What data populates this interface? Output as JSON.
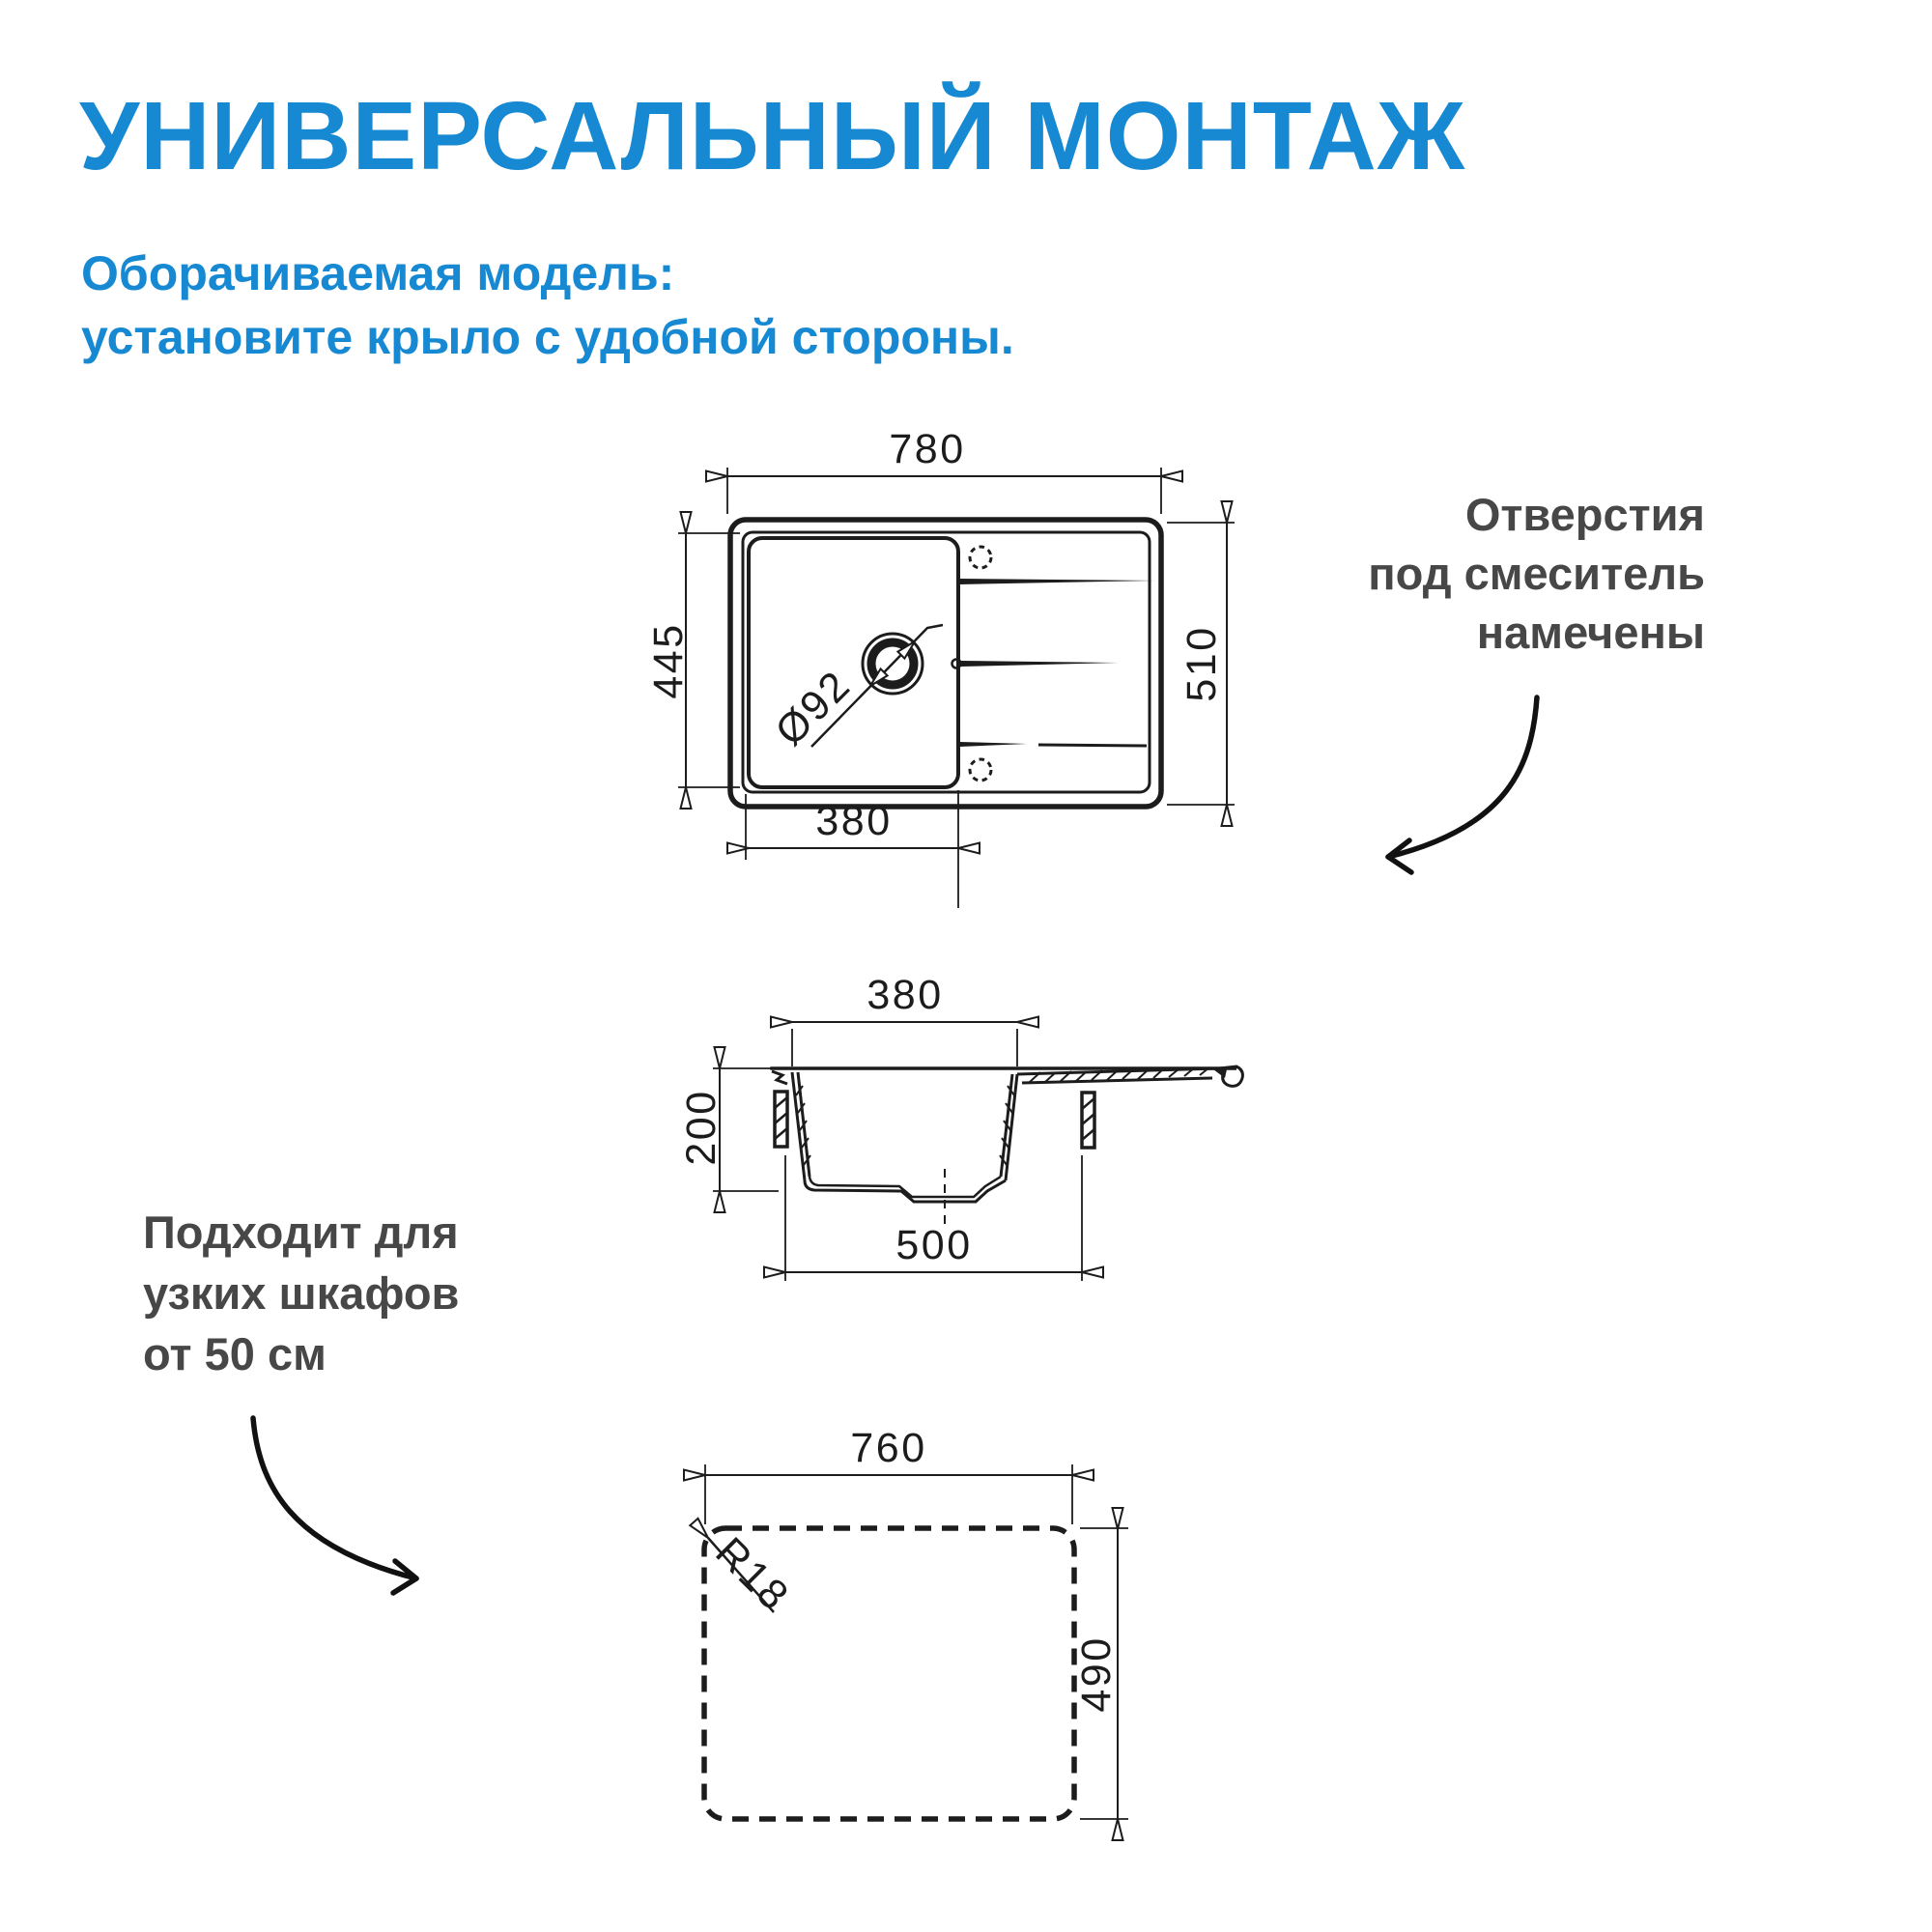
{
  "header": {
    "title": "УНИВЕРСАЛЬНЫЙ МОНТАЖ",
    "subtitle_line1": "Оборачиваемая модель:",
    "subtitle_line2": "установите крыло с удобной стороны."
  },
  "notes": {
    "faucet": {
      "line1": "Отверстия",
      "line2": "под смеситель",
      "line3": "намечены"
    },
    "cabinet": {
      "line1": "Подходит для",
      "line2": "узких шкафов",
      "line3": "от 50 см"
    }
  },
  "top_view": {
    "overall_width": "780",
    "overall_depth": "510",
    "bowl_depth": "445",
    "bowl_width": "380",
    "drain_diameter": "Ø92"
  },
  "section_view": {
    "bowl_width": "380",
    "bowl_depth": "200",
    "min_cabinet": "500"
  },
  "cutout_view": {
    "cut_width": "760",
    "cut_depth": "490",
    "corner_radius": "R18"
  },
  "colors": {
    "accent_blue": "#1789d2",
    "note_gray": "#474747",
    "line_black": "#1c1c1c"
  }
}
